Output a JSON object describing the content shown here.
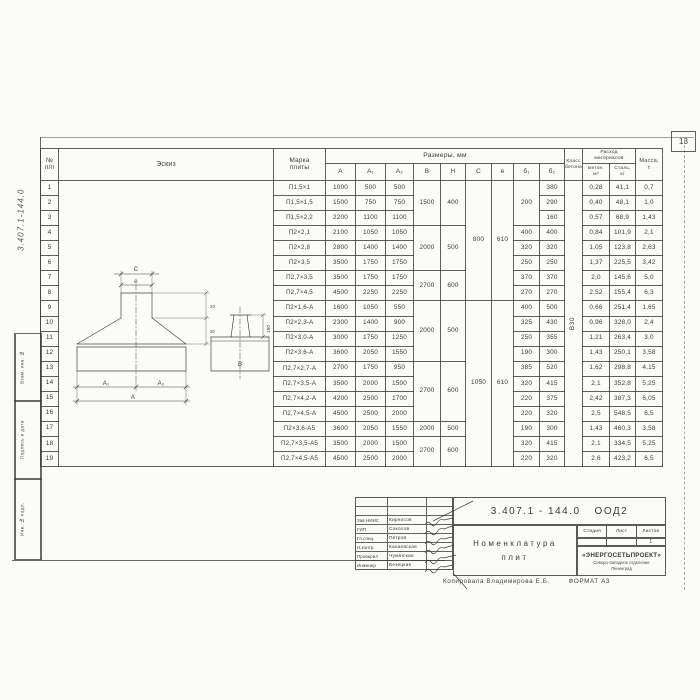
{
  "sheet": {
    "page_number": "13",
    "margin_doc_number": "3.407.1-144.0",
    "copier_line": "Копировала Владимирова Е.Б.",
    "format_label": "ФОРМАТ А3"
  },
  "margin_stamps": {
    "stamp1": "Взам. инв. №",
    "stamp2": "Подпись и дата",
    "stamp3": "Инв. № подл."
  },
  "table": {
    "headers": {
      "num_l1": "№",
      "num_l2": "п/п",
      "sketch": "Эскиз",
      "mark_l1": "Марка",
      "mark_l2": "плиты",
      "dims": "Размеры, мм",
      "dim_cols": [
        "А",
        "А₁",
        "А₂",
        "В",
        "Н",
        "С",
        "е",
        "б₁",
        "б₂"
      ],
      "class_l1": "Класс",
      "class_l2": "бетона",
      "consumption_l1": "Расход",
      "consumption_l2": "материалов",
      "concrete_l1": "Бетон,",
      "concrete_l2": "м³",
      "steel_l1": "Сталь,",
      "steel_l2": "кг",
      "mass_l1": "Масса,",
      "mass_l2": "т"
    },
    "concrete_class": "В30",
    "rows": [
      {
        "n": "1",
        "mark": "П1,5×1",
        "cells": [
          {
            "v": "1000"
          },
          {
            "v": "500"
          },
          {
            "v": "500"
          },
          {
            "v": "1500",
            "rs": 3
          },
          {
            "v": "400",
            "rs": 3
          },
          {
            "v": "800",
            "rs": 8
          },
          {
            "v": "610",
            "rs": 8
          },
          {
            "v": "200",
            "rs": 3
          },
          {
            "v": "380"
          },
          {
            "v": "0,28"
          },
          {
            "v": "41,1"
          },
          {
            "v": "0,7"
          }
        ]
      },
      {
        "n": "2",
        "mark": "П1,5×1,5",
        "cells": [
          {
            "v": "1500"
          },
          {
            "v": "750"
          },
          {
            "v": "750"
          },
          {
            "v": "290"
          },
          {
            "v": "0,40"
          },
          {
            "v": "48,1"
          },
          {
            "v": "1,0"
          }
        ]
      },
      {
        "n": "3",
        "mark": "П1,5×2,2",
        "cells": [
          {
            "v": "2200"
          },
          {
            "v": "1100"
          },
          {
            "v": "1100"
          },
          {
            "v": "160"
          },
          {
            "v": "0,57"
          },
          {
            "v": "68,9"
          },
          {
            "v": "1,43"
          }
        ]
      },
      {
        "n": "4",
        "mark": "П2×2,1",
        "cells": [
          {
            "v": "2100"
          },
          {
            "v": "1050"
          },
          {
            "v": "1050"
          },
          {
            "v": "2000",
            "rs": 3
          },
          {
            "v": "500",
            "rs": 3
          },
          {
            "v": "400"
          },
          {
            "v": "400"
          },
          {
            "v": "0,84"
          },
          {
            "v": "101,9"
          },
          {
            "v": "2,1"
          }
        ]
      },
      {
        "n": "5",
        "mark": "П2×2,8",
        "cells": [
          {
            "v": "2800"
          },
          {
            "v": "1400"
          },
          {
            "v": "1400"
          },
          {
            "v": "320"
          },
          {
            "v": "320"
          },
          {
            "v": "1,05"
          },
          {
            "v": "123,8"
          },
          {
            "v": "2,63"
          }
        ]
      },
      {
        "n": "6",
        "mark": "П2×3,5",
        "cells": [
          {
            "v": "3500"
          },
          {
            "v": "1750"
          },
          {
            "v": "1750"
          },
          {
            "v": "250"
          },
          {
            "v": "250"
          },
          {
            "v": "1,37"
          },
          {
            "v": "225,5"
          },
          {
            "v": "3,42"
          }
        ]
      },
      {
        "n": "7",
        "mark": "П2,7×3,5",
        "cells": [
          {
            "v": "3500"
          },
          {
            "v": "1750"
          },
          {
            "v": "1750"
          },
          {
            "v": "2700",
            "rs": 2
          },
          {
            "v": "600",
            "rs": 2
          },
          {
            "v": "370"
          },
          {
            "v": "370"
          },
          {
            "v": "2,0"
          },
          {
            "v": "145,6"
          },
          {
            "v": "5,0"
          }
        ]
      },
      {
        "n": "8",
        "mark": "П2,7×4,5",
        "cells": [
          {
            "v": "4500"
          },
          {
            "v": "2250"
          },
          {
            "v": "2250"
          },
          {
            "v": "270"
          },
          {
            "v": "270"
          },
          {
            "v": "2,52"
          },
          {
            "v": "155,4"
          },
          {
            "v": "6,3"
          }
        ]
      },
      {
        "n": "9",
        "mark": "П2×1,6-А",
        "cells": [
          {
            "v": "1600"
          },
          {
            "v": "1050"
          },
          {
            "v": "550"
          },
          {
            "v": "2000",
            "rs": 4
          },
          {
            "v": "500",
            "rs": 4
          },
          {
            "v": "1050",
            "rs": 11
          },
          {
            "v": "610",
            "rs": 11
          },
          {
            "v": "400"
          },
          {
            "v": "500"
          },
          {
            "v": "0,66"
          },
          {
            "v": "251,4"
          },
          {
            "v": "1,65"
          }
        ]
      },
      {
        "n": "10",
        "mark": "П2×2,3-А",
        "cells": [
          {
            "v": "2300"
          },
          {
            "v": "1400"
          },
          {
            "v": "900"
          },
          {
            "v": "325"
          },
          {
            "v": "430"
          },
          {
            "v": "0,96"
          },
          {
            "v": "328,0"
          },
          {
            "v": "2,4"
          }
        ]
      },
      {
        "n": "11",
        "mark": "П2×3,0-А",
        "cells": [
          {
            "v": "3000"
          },
          {
            "v": "1750"
          },
          {
            "v": "1250"
          },
          {
            "v": "250"
          },
          {
            "v": "355"
          },
          {
            "v": "1,21"
          },
          {
            "v": "263,4"
          },
          {
            "v": "3,0"
          }
        ]
      },
      {
        "n": "12",
        "mark": "П2×3,6-А",
        "cells": [
          {
            "v": "3600"
          },
          {
            "v": "2050"
          },
          {
            "v": "1550"
          },
          {
            "v": "190"
          },
          {
            "v": "300"
          },
          {
            "v": "1,43"
          },
          {
            "v": "250,1"
          },
          {
            "v": "3,58"
          }
        ]
      },
      {
        "n": "13",
        "mark": "П2,7×2,7-А",
        "cells": [
          {
            "v": "2700"
          },
          {
            "v": "1750"
          },
          {
            "v": "950"
          },
          {
            "v": "2700",
            "rs": 4
          },
          {
            "v": "600",
            "rs": 4
          },
          {
            "v": "385"
          },
          {
            "v": "520"
          },
          {
            "v": "1,62"
          },
          {
            "v": "298,8"
          },
          {
            "v": "4,15"
          }
        ]
      },
      {
        "n": "14",
        "mark": "П2,7×3,5-А",
        "cells": [
          {
            "v": "3500"
          },
          {
            "v": "2000"
          },
          {
            "v": "1500"
          },
          {
            "v": "320"
          },
          {
            "v": "415"
          },
          {
            "v": "2,1"
          },
          {
            "v": "352,8"
          },
          {
            "v": "5,25"
          }
        ]
      },
      {
        "n": "15",
        "mark": "П2,7×4,2-А",
        "cells": [
          {
            "v": "4200"
          },
          {
            "v": "2500"
          },
          {
            "v": "1700"
          },
          {
            "v": "220"
          },
          {
            "v": "375"
          },
          {
            "v": "2,42"
          },
          {
            "v": "387,3"
          },
          {
            "v": "6,05"
          }
        ]
      },
      {
        "n": "16",
        "mark": "П2,7×4,5-А",
        "cells": [
          {
            "v": "4500"
          },
          {
            "v": "2500"
          },
          {
            "v": "2000"
          },
          {
            "v": "220"
          },
          {
            "v": "320"
          },
          {
            "v": "2,5"
          },
          {
            "v": "548,5"
          },
          {
            "v": "6,5"
          }
        ]
      },
      {
        "n": "17",
        "mark": "П2×3,6-А5",
        "cells": [
          {
            "v": "3600"
          },
          {
            "v": "2050"
          },
          {
            "v": "1550"
          },
          {
            "v": "2000"
          },
          {
            "v": "500"
          },
          {
            "v": "190"
          },
          {
            "v": "300"
          },
          {
            "v": "1,43"
          },
          {
            "v": "460,3"
          },
          {
            "v": "3,58"
          }
        ]
      },
      {
        "n": "18",
        "mark": "П2,7×3,5-А5",
        "cells": [
          {
            "v": "3500"
          },
          {
            "v": "2000"
          },
          {
            "v": "1500"
          },
          {
            "v": "2700",
            "rs": 2
          },
          {
            "v": "600",
            "rs": 2
          },
          {
            "v": "320"
          },
          {
            "v": "415"
          },
          {
            "v": "2,1"
          },
          {
            "v": "334,5"
          },
          {
            "v": "5,25"
          }
        ]
      },
      {
        "n": "19",
        "mark": "П2,7×4,5-А5",
        "cells": [
          {
            "v": "4500"
          },
          {
            "v": "2500"
          },
          {
            "v": "2000"
          },
          {
            "v": "220"
          },
          {
            "v": "320"
          },
          {
            "v": "2,6"
          },
          {
            "v": "423,2"
          },
          {
            "v": "6,5"
          }
        ]
      }
    ]
  },
  "sketch_labels": {
    "c": "C",
    "e": "е",
    "a1": "А₁",
    "a2": "А₂",
    "a": "А",
    "b": "В",
    "h180": "180",
    "h20": "20",
    "h30": "30"
  },
  "title_block": {
    "doc_number": "3.407.1 - 144.0",
    "doc_code": "ООД2",
    "title_l1": "Номенклатура",
    "title_l2": "плит",
    "stage_label": "Стадия",
    "sheet_label": "Лист",
    "sheets_label": "Листов",
    "sheets_value": "1",
    "org_name": "«ЭНЕРГОСЕТЬПРОЕКТ»",
    "org_line2": "Северо-Западное отделение",
    "org_line3": "Ленинград",
    "people": [
      {
        "role": "Зав.НИИС",
        "name": "Кирносов"
      },
      {
        "role": "ГИП",
        "name": "Соколов"
      },
      {
        "role": "Гл.спец.",
        "name": "Петров"
      },
      {
        "role": "Н.контр.",
        "name": "Канаевская"
      },
      {
        "role": "Проверил",
        "name": "Чукинская"
      },
      {
        "role": "Инженер",
        "name": "Безецкая"
      }
    ]
  }
}
